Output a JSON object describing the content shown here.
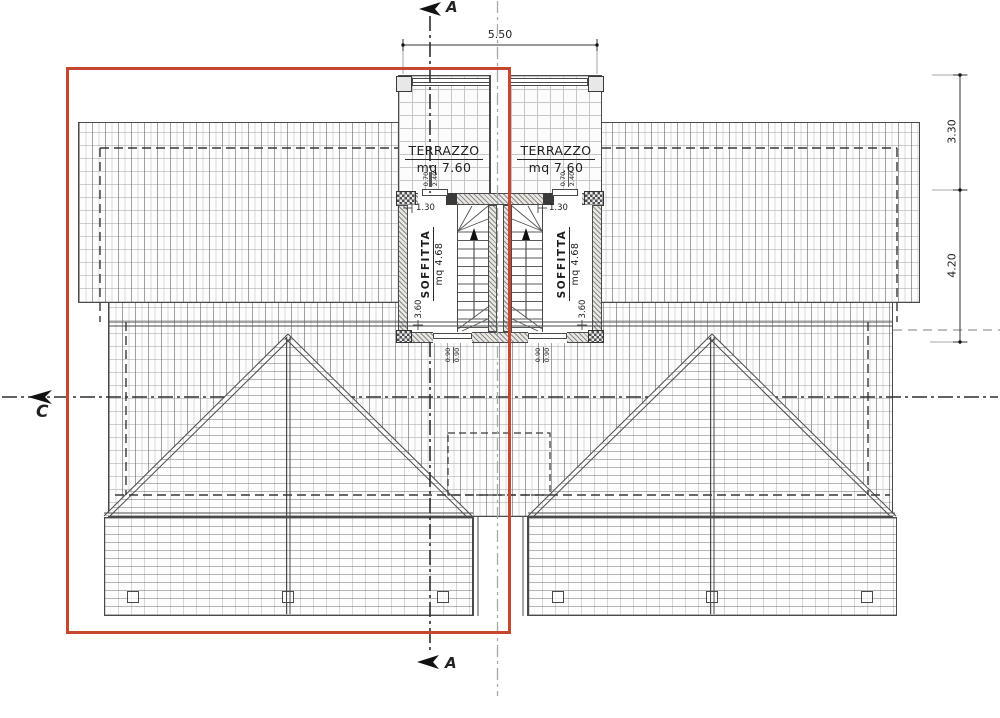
{
  "rooms": {
    "terrace_left": {
      "name": "TERRAZZO",
      "area": "mq 7.60"
    },
    "terrace_right": {
      "name": "TERRAZZO",
      "area": "mq 7.60"
    },
    "attic_left": {
      "name": "SOFFITTA",
      "area": "mq 4.68"
    },
    "attic_right": {
      "name": "SOFFITTA",
      "area": "mq 4.68"
    }
  },
  "dimensions": {
    "top_width": "5.50",
    "right_upper": "3.30",
    "right_lower": "4.20",
    "attic_width_left": "1.30",
    "attic_width_right": "1.30",
    "attic_depth_left": "3.60",
    "attic_depth_right": "3.60",
    "opening_top_left": {
      "width": "0.70",
      "height": "2.40"
    },
    "opening_top_right": {
      "width": "0.70",
      "height": "2.40"
    },
    "opening_bottom_left": {
      "width": "0.90",
      "height": "0.90"
    },
    "opening_bottom_right": {
      "width": "0.90",
      "height": "0.90"
    }
  },
  "sections": {
    "a_top": "A",
    "a_bottom": "A",
    "c_left": "C"
  },
  "colors": {
    "highlight": "#c7472e",
    "ink": "#3c3c3c"
  }
}
